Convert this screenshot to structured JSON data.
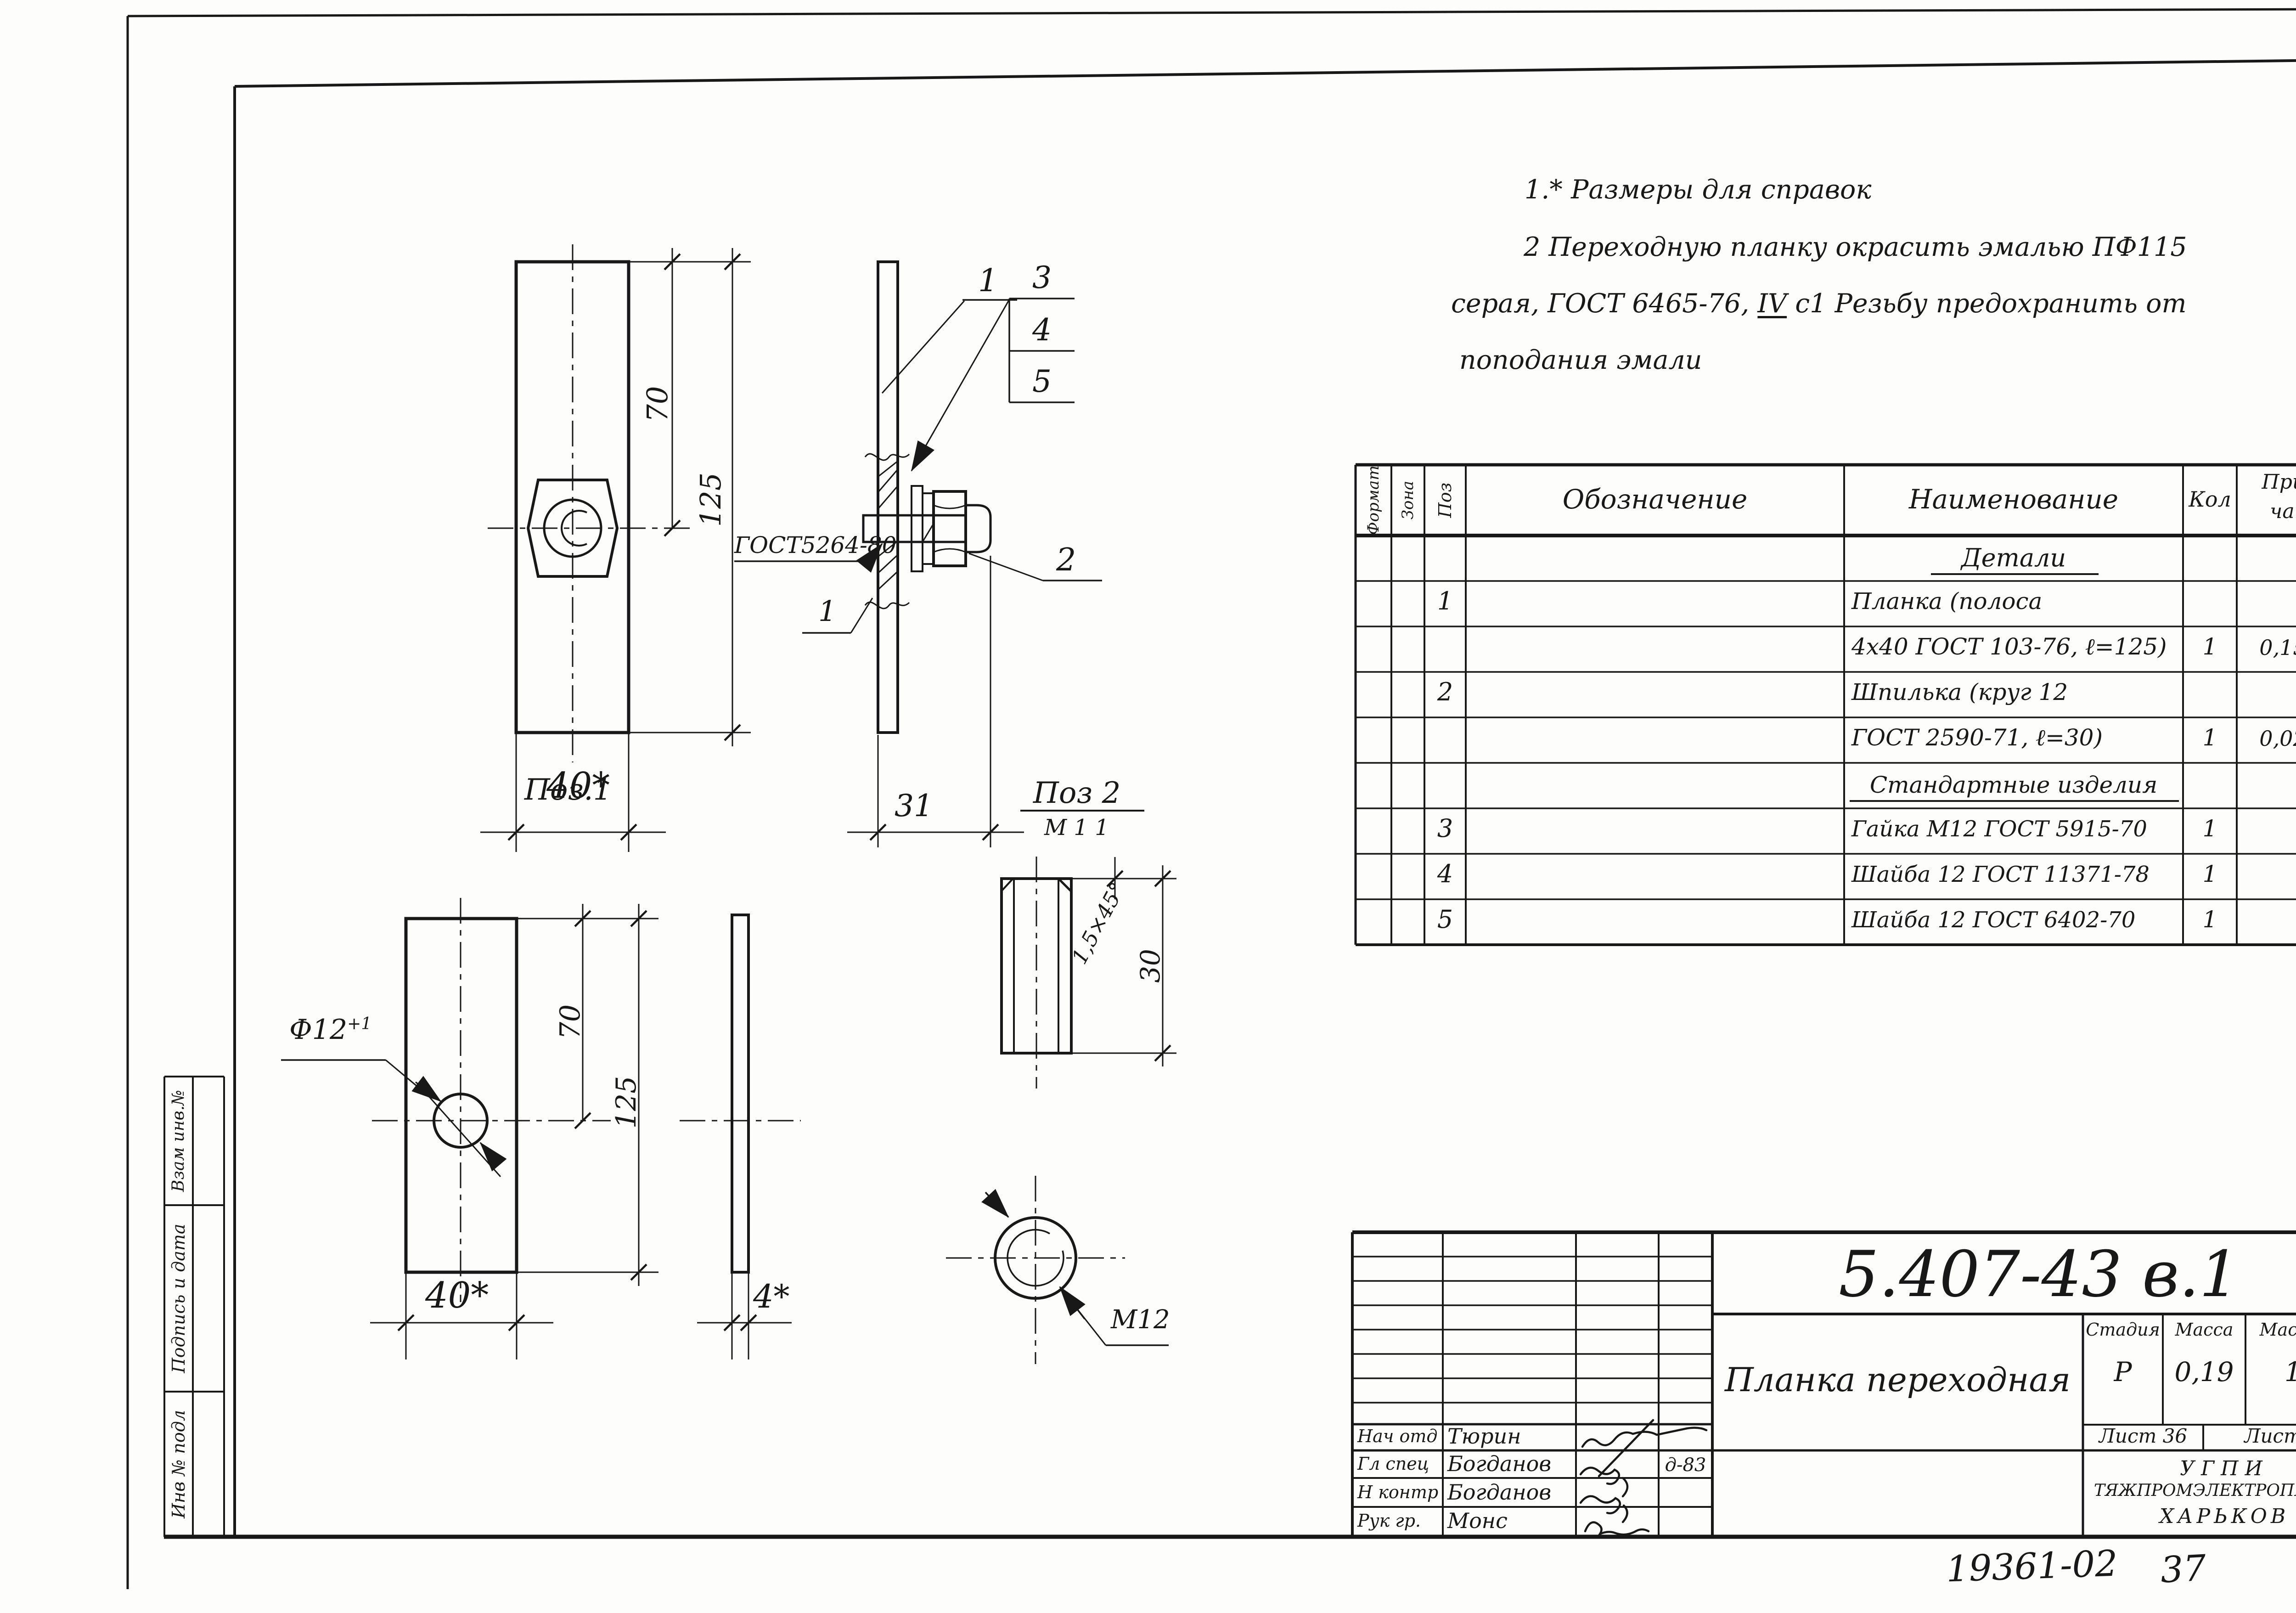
{
  "page": {
    "corner_sheet_number": "36",
    "footer_doc_number": "19361-02",
    "footer_sheet_number": "37"
  },
  "notes": {
    "line1": "1.* Размеры для справок",
    "line2": "2 Переходную планку окрасить эмалью ПФ115",
    "line3_before": "серая, ГОСТ 6465-76, ",
    "line3_roman": "IV",
    "line3_after": " с1  Резьбу предохранить от",
    "line4": "поподания эмали"
  },
  "views": {
    "poz1_label": "Поз.1",
    "poz2_label": "Поз 2",
    "poz2_scale": "М 1 1",
    "callout_1": "1",
    "callout_2": "2",
    "callout_3": "3",
    "callout_4": "4",
    "callout_5": "5",
    "weld_gost": "ГОСТ5264-80",
    "weld_size": "1",
    "asm_dim_70": "70",
    "asm_dim_125": "125",
    "asm_dim_40": "40*",
    "asm_dim_31": "31",
    "p1_dim_70": "70",
    "p1_dim_125": "125",
    "p1_dim_40": "40*",
    "p1_dim_4": "4*",
    "p1_hole_dia": "Ф12",
    "p1_hole_tol": "+1",
    "p2_chamfer": "1,5×45°",
    "p2_dim_30": "30",
    "p2_thread": "М12"
  },
  "spec_table": {
    "headers": {
      "format": "Формат",
      "zona": "Зона",
      "poz": "Поз",
      "designation": "Обозначение",
      "name": "Наименование",
      "qty": "Кол",
      "note1": "Приме-",
      "note2": "чание"
    },
    "rows": [
      {
        "poz": "",
        "name": "Детали",
        "qty": "",
        "note": ""
      },
      {
        "poz": "1",
        "name": "Планка (полоса",
        "qty": "",
        "note": ""
      },
      {
        "poz": "",
        "name": "4х40  ГОСТ 103-76, ℓ=125)",
        "qty": "1",
        "note": "0,157кг"
      },
      {
        "poz": "2",
        "name": "Шпилька (круг 12",
        "qty": "",
        "note": ""
      },
      {
        "poz": "",
        "name": "ГОСТ 2590-71, ℓ=30)",
        "qty": "1",
        "note": "0,027кг"
      },
      {
        "poz": "",
        "name": "Стандартные изделия",
        "qty": "",
        "note": ""
      },
      {
        "poz": "3",
        "name": "Гайка М12 ГОСТ 5915-70",
        "qty": "1",
        "note": ""
      },
      {
        "poz": "4",
        "name": "Шайба 12 ГОСТ 11371-78",
        "qty": "1",
        "note": ""
      },
      {
        "poz": "5",
        "name": "Шайба 12 ГОСТ 6402-70",
        "qty": "1",
        "note": ""
      }
    ]
  },
  "stamp": {
    "doc_code": "5.407-43 в.1",
    "title": "Планка переходная",
    "stage_label": "Стадия",
    "mass_label": "Масса",
    "scale_label": "Масштаб",
    "stage_value": "Р",
    "mass_value": "0,19",
    "scale_value": "1 2",
    "sheet_label": "Лист 36",
    "sheets_label": "Листов",
    "org_line1": "УГПИ",
    "org_line2": "ТЯЖПРОМЭЛЕКТРОПРОЕКТ",
    "org_line3": "ХАРЬКОВ",
    "rows": [
      {
        "role": "Нач отд",
        "name": "Тюрин",
        "date": ""
      },
      {
        "role": "Гл спец",
        "name": "Богданов",
        "date": "д-83"
      },
      {
        "role": "Н контр",
        "name": "Богданов",
        "date": ""
      },
      {
        "role": "Рук гр.",
        "name": "Монс",
        "date": ""
      }
    ]
  },
  "sidebar": {
    "row1": "Взам инв.№",
    "row2": "Подпись и дата",
    "row3": "Инв № подл"
  }
}
